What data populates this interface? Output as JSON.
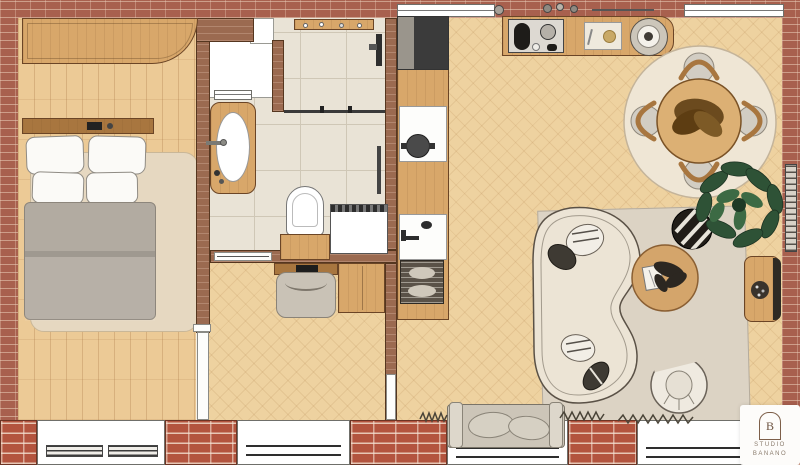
{
  "logo": {
    "monogram": "B",
    "line1": "STUDIO",
    "line2": "BANANO"
  },
  "colors": {
    "brick": "#a8604e",
    "brick_bright": "#b3543e",
    "wall": "#9b6a50",
    "wall_outline": "#55361f",
    "floor_bedroom": "#ecca96",
    "floor_living": "#eed2a0",
    "floor_line": "#c99e66",
    "tile": "#e9e3d6",
    "tile_line": "#cfc7b6",
    "wood": "#d8a76a",
    "wood_dark": "#a8763f",
    "wood_edge": "#6b4526",
    "white_fixture": "#fbfaf7",
    "gray_blanket": "#b2aba1",
    "rug_bed": "#e6d8c1",
    "rug_living": "#dcd3c4",
    "rug_dining": "#efe6d5",
    "sofa": "#ece4d5",
    "cushion_dark": "#3e3a33",
    "table_wood": "#dcb074",
    "chair_seat": "#d2cdc3",
    "centerpiece": "#6b4a1e",
    "plant": "#2e5236",
    "plant_dark": "#1e3a26",
    "pouf": "#211d18",
    "logo_text": "#8a7b6c",
    "logo_line": "#7d5f49"
  },
  "plan": {
    "type": "apartment-floor-plan-top-view",
    "rooms": [
      {
        "name": "bedroom",
        "furniture": [
          "wardrobe",
          "double-bed",
          "headboard-shelf",
          "pillows-x4",
          "gray-duvet",
          "area-rug",
          "window-with-radiators",
          "door"
        ]
      },
      {
        "name": "bathroom",
        "furniture": [
          "walk-in-shower",
          "shower-shelf",
          "shower-head",
          "glass-partition",
          "vanity-with-oval-basin",
          "toilet",
          "under-toilet-cabinet",
          "washing-machine",
          "towel-rail",
          "lightwell-window"
        ]
      },
      {
        "name": "hallway",
        "furniture": [
          "wall-desk",
          "keyboard",
          "desk-chair",
          "cabinet",
          "sliding-door",
          "door-to-living"
        ]
      },
      {
        "name": "kitchen",
        "furniture": [
          "tall-dark-appliance",
          "counter-run",
          "cooktop-with-pot",
          "sink-with-faucet",
          "dish-rack",
          "coffee-bar-counter",
          "espresso-machine",
          "cutting-board",
          "round-tray",
          "wall-jars"
        ]
      },
      {
        "name": "living-dining",
        "furniture": [
          "round-dining-table",
          "dining-chairs-x4",
          "round-cream-rug",
          "dried-flower-centerpiece",
          "fiddle-leaf-plant",
          "curved-organic-sofa",
          "striped-cushions",
          "round-coffee-table",
          "book",
          "black-striped-pouf",
          "ribbed-armchair",
          "window-bench-with-cushions",
          "curtain-squiggles",
          "sideboard",
          "wall-radiator",
          "windows"
        ]
      }
    ]
  }
}
